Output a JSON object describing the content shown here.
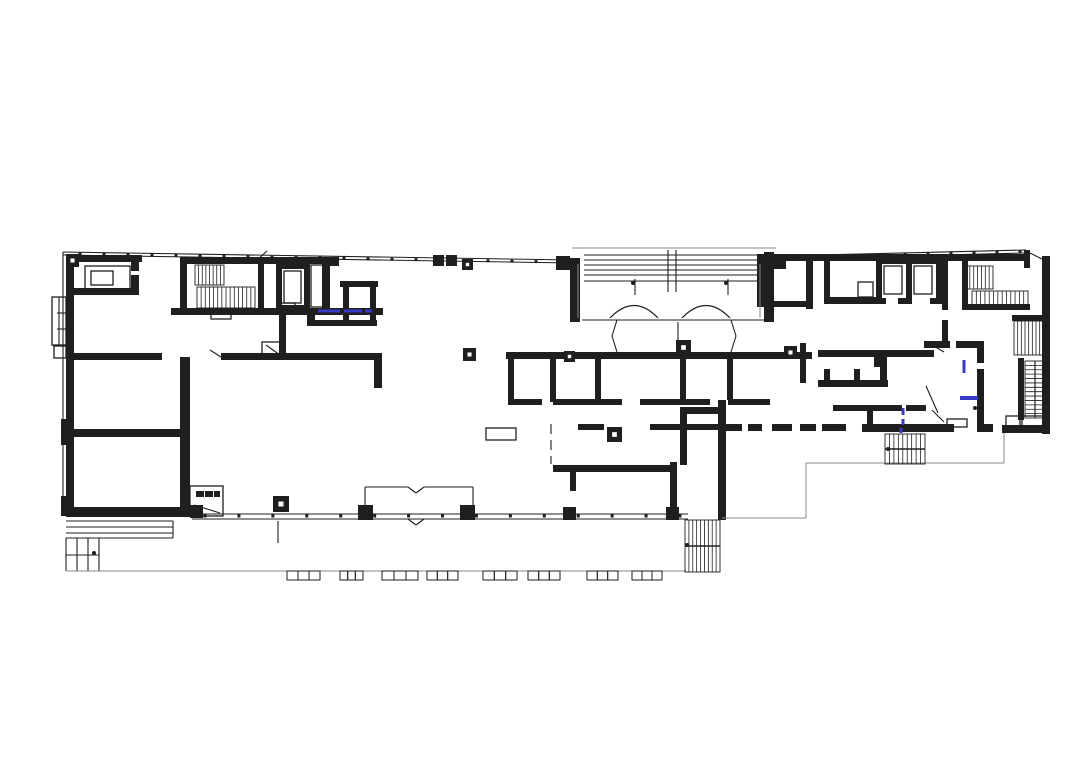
{
  "document": {
    "type": "architectural-floor-plan",
    "background": "#ffffff"
  },
  "colors": {
    "ink": "#1f1f1f",
    "faint": "#8a8a8a",
    "accent": "#3a3ac8",
    "white": "#ffffff"
  },
  "plan": {
    "canvas": {
      "w": 1072,
      "h": 768
    },
    "walls": [
      [
        66,
        255,
        76,
        7
      ],
      [
        66,
        255,
        8,
        258
      ],
      [
        66,
        288,
        70,
        7
      ],
      [
        131,
        255,
        8,
        16
      ],
      [
        131,
        275,
        8,
        20
      ],
      [
        66,
        353,
        96,
        7
      ],
      [
        221,
        353,
        160,
        7
      ],
      [
        374,
        353,
        8,
        35
      ],
      [
        66,
        429,
        124,
        8
      ],
      [
        180,
        357,
        10,
        156
      ],
      [
        66,
        507,
        128,
        10
      ],
      [
        61,
        419,
        8,
        26
      ],
      [
        61,
        496,
        8,
        20
      ],
      [
        180,
        257,
        147,
        7
      ],
      [
        171,
        308,
        212,
        7
      ],
      [
        180,
        257,
        7,
        55
      ],
      [
        258,
        263,
        6,
        45
      ],
      [
        276,
        263,
        34,
        6
      ],
      [
        276,
        305,
        34,
        6
      ],
      [
        276,
        263,
        6,
        48
      ],
      [
        304,
        263,
        6,
        48
      ],
      [
        322,
        257,
        8,
        56
      ],
      [
        279,
        311,
        7,
        46
      ],
      [
        340,
        281,
        38,
        6
      ],
      [
        343,
        283,
        6,
        40
      ],
      [
        370,
        283,
        6,
        40
      ],
      [
        307,
        312,
        8,
        14
      ],
      [
        307,
        320,
        70,
        6
      ],
      [
        757,
        254,
        272,
        7
      ],
      [
        757,
        254,
        7,
        52
      ],
      [
        806,
        261,
        7,
        48
      ],
      [
        757,
        301,
        55,
        6
      ],
      [
        824,
        261,
        6,
        42
      ],
      [
        824,
        297,
        58,
        7
      ],
      [
        876,
        258,
        6,
        46
      ],
      [
        906,
        258,
        6,
        46
      ],
      [
        936,
        258,
        6,
        46
      ],
      [
        876,
        258,
        66,
        6
      ],
      [
        876,
        298,
        10,
        6
      ],
      [
        898,
        298,
        12,
        6
      ],
      [
        930,
        298,
        12,
        6
      ],
      [
        942,
        258,
        6,
        52
      ],
      [
        942,
        320,
        6,
        28
      ],
      [
        924,
        341,
        26,
        7
      ],
      [
        956,
        341,
        26,
        7
      ],
      [
        977,
        341,
        7,
        22
      ],
      [
        977,
        369,
        7,
        62
      ],
      [
        962,
        258,
        6,
        50
      ],
      [
        962,
        304,
        68,
        6
      ],
      [
        1042,
        256,
        8,
        178
      ],
      [
        1024,
        250,
        6,
        18
      ],
      [
        1012,
        315,
        38,
        6
      ],
      [
        1018,
        358,
        6,
        62
      ],
      [
        1002,
        425,
        46,
        8
      ],
      [
        862,
        424,
        92,
        8
      ],
      [
        977,
        424,
        16,
        8
      ],
      [
        822,
        424,
        24,
        7
      ],
      [
        800,
        424,
        16,
        7
      ],
      [
        772,
        424,
        20,
        7
      ],
      [
        748,
        424,
        14,
        7
      ],
      [
        726,
        424,
        16,
        7
      ],
      [
        718,
        400,
        8,
        120
      ],
      [
        683,
        407,
        39,
        7
      ],
      [
        680,
        407,
        7,
        58
      ],
      [
        670,
        462,
        7,
        57
      ],
      [
        506,
        352,
        306,
        7
      ],
      [
        800,
        343,
        6,
        40
      ],
      [
        818,
        350,
        116,
        7
      ],
      [
        874,
        353,
        6,
        14
      ],
      [
        880,
        353,
        7,
        32
      ],
      [
        818,
        380,
        70,
        7
      ],
      [
        824,
        369,
        6,
        11
      ],
      [
        854,
        369,
        6,
        11
      ],
      [
        833,
        405,
        34,
        6
      ],
      [
        872,
        405,
        30,
        6
      ],
      [
        906,
        405,
        20,
        6
      ],
      [
        867,
        405,
        6,
        25
      ],
      [
        508,
        352,
        6,
        50
      ],
      [
        550,
        352,
        6,
        50
      ],
      [
        595,
        352,
        6,
        50
      ],
      [
        680,
        352,
        6,
        50
      ],
      [
        727,
        352,
        6,
        48
      ],
      [
        508,
        399,
        34,
        6
      ],
      [
        553,
        399,
        69,
        6
      ],
      [
        640,
        399,
        70,
        6
      ],
      [
        728,
        399,
        42,
        6
      ],
      [
        578,
        424,
        26,
        6
      ],
      [
        650,
        424,
        72,
        6
      ],
      [
        553,
        465,
        122,
        7
      ],
      [
        570,
        465,
        6,
        26
      ],
      [
        570,
        258,
        10,
        64
      ],
      [
        764,
        252,
        10,
        70
      ],
      [
        196,
        491,
        8,
        6
      ],
      [
        205,
        491,
        8,
        6
      ],
      [
        214,
        491,
        6,
        6
      ]
    ],
    "boxes": [
      [
        85,
        266,
        45,
        25
      ],
      [
        91,
        271,
        22,
        14
      ],
      [
        284,
        271,
        17,
        32
      ],
      [
        311,
        265,
        14,
        42
      ],
      [
        884,
        266,
        18,
        28
      ],
      [
        914,
        266,
        18,
        28
      ],
      [
        858,
        282,
        15,
        15
      ],
      [
        190,
        486,
        33,
        30
      ],
      [
        486,
        428,
        30,
        12
      ],
      [
        947,
        419,
        20,
        8
      ],
      [
        1006,
        416,
        14,
        11
      ],
      [
        1022,
        416,
        22,
        11
      ],
      [
        52,
        297,
        14,
        48
      ],
      [
        54,
        346,
        12,
        12
      ],
      [
        211,
        313,
        20,
        6
      ],
      [
        279,
        303,
        16,
        7
      ],
      [
        262,
        342,
        22,
        15
      ]
    ],
    "thin": [
      [
        63,
        252,
        572,
        260
      ],
      [
        63,
        255,
        572,
        263
      ],
      [
        776,
        256,
        1026,
        250
      ],
      [
        776,
        259,
        1026,
        253
      ],
      [
        63,
        252,
        63,
        513
      ],
      [
        584,
        255,
        764,
        255
      ],
      [
        584,
        260,
        764,
        260
      ],
      [
        584,
        265,
        764,
        265
      ],
      [
        584,
        270,
        764,
        270
      ],
      [
        584,
        275,
        764,
        275
      ],
      [
        584,
        281,
        764,
        281
      ],
      [
        582,
        320,
        764,
        320
      ],
      [
        668,
        250,
        668,
        292
      ],
      [
        676,
        250,
        676,
        292
      ],
      [
        635,
        279,
        635,
        295
      ],
      [
        728,
        279,
        728,
        295
      ],
      [
        678,
        322,
        678,
        352
      ],
      [
        192,
        514,
        688,
        514
      ],
      [
        192,
        519,
        688,
        519
      ],
      [
        365,
        487,
        408,
        487
      ],
      [
        408,
        487,
        416,
        493
      ],
      [
        416,
        493,
        424,
        487
      ],
      [
        424,
        487,
        473,
        487
      ],
      [
        365,
        487,
        365,
        514
      ],
      [
        473,
        487,
        473,
        514
      ],
      [
        408,
        519,
        416,
        525
      ],
      [
        416,
        525,
        424,
        519
      ],
      [
        66,
        521,
        173,
        521
      ],
      [
        66,
        527,
        173,
        527
      ],
      [
        66,
        533,
        173,
        533
      ],
      [
        66,
        538,
        173,
        538
      ],
      [
        173,
        521,
        173,
        538
      ],
      [
        66,
        538,
        66,
        571
      ],
      [
        77,
        538,
        77,
        571
      ],
      [
        88,
        538,
        88,
        571
      ],
      [
        99,
        538,
        99,
        571
      ],
      [
        66,
        555,
        99,
        555
      ],
      [
        66,
        571,
        99,
        571
      ],
      [
        551,
        424,
        551,
        434
      ],
      [
        551,
        440,
        551,
        450
      ],
      [
        551,
        456,
        551,
        464
      ],
      [
        278,
        521,
        278,
        543
      ],
      [
        1026,
        251,
        1046,
        261
      ],
      [
        255,
        262,
        267,
        251
      ],
      [
        926,
        386,
        938,
        413
      ],
      [
        932,
        345,
        944,
        352
      ],
      [
        210,
        350,
        221,
        357
      ],
      [
        617,
        320,
        612,
        336
      ],
      [
        612,
        336,
        617,
        352
      ],
      [
        731,
        320,
        736,
        336
      ],
      [
        736,
        336,
        731,
        352
      ],
      [
        932,
        410,
        944,
        422
      ],
      [
        266,
        345,
        280,
        355
      ],
      [
        194,
        505,
        220,
        513
      ],
      [
        57,
        313,
        66,
        313
      ],
      [
        57,
        329,
        66,
        329
      ],
      [
        59,
        297,
        59,
        345
      ]
    ],
    "faint": [
      [
        66,
        571,
        686,
        571
      ],
      [
        722,
        518,
        806,
        518
      ],
      [
        806,
        518,
        806,
        463
      ],
      [
        806,
        463,
        1004,
        463
      ],
      [
        1004,
        463,
        1004,
        433
      ],
      [
        578,
        264,
        578,
        318
      ],
      [
        760,
        264,
        760,
        318
      ],
      [
        572,
        248,
        776,
        248
      ]
    ],
    "stairs": [
      {
        "x": 195,
        "y": 265,
        "w": 29,
        "h": 20,
        "dir": "v",
        "n": 7,
        "mid": false,
        "rail": false
      },
      {
        "x": 197,
        "y": 287,
        "w": 58,
        "h": 21,
        "dir": "v",
        "n": 13,
        "mid": false,
        "rail": false
      },
      {
        "x": 966,
        "y": 266,
        "w": 27,
        "h": 23,
        "dir": "v",
        "n": 6,
        "mid": false,
        "rail": false
      },
      {
        "x": 972,
        "y": 291,
        "w": 56,
        "h": 14,
        "dir": "v",
        "n": 12,
        "mid": false,
        "rail": false
      },
      {
        "x": 1014,
        "y": 321,
        "w": 33,
        "h": 34,
        "dir": "v",
        "n": 8,
        "mid": false,
        "rail": false
      },
      {
        "x": 1025,
        "y": 361,
        "w": 20,
        "h": 57,
        "dir": "h",
        "n": 12,
        "mid": false,
        "rail": true
      },
      {
        "x": 885,
        "y": 434,
        "w": 40,
        "h": 30,
        "dir": "v",
        "n": 8,
        "mid": true,
        "rail": false
      },
      {
        "x": 685,
        "y": 520,
        "w": 35,
        "h": 52,
        "dir": "v",
        "n": 8,
        "mid": true,
        "rail": false
      }
    ],
    "columns_solid": [
      [
        556,
        256,
        14
      ],
      [
        773,
        256,
        13
      ],
      [
        433,
        255,
        11
      ],
      [
        446,
        255,
        11
      ],
      [
        330,
        257,
        9
      ],
      [
        190,
        505,
        13
      ],
      [
        358,
        505,
        15
      ],
      [
        460,
        505,
        15
      ],
      [
        563,
        507,
        13
      ],
      [
        666,
        507,
        13
      ]
    ],
    "columns_framed": [
      [
        66,
        254,
        13
      ],
      [
        462,
        259,
        11
      ],
      [
        463,
        348,
        13
      ],
      [
        564,
        351,
        11
      ],
      [
        676,
        340,
        15
      ],
      [
        607,
        427,
        15
      ],
      [
        784,
        346,
        13
      ],
      [
        273,
        496,
        16
      ]
    ],
    "arcs": [
      {
        "x1": 610,
        "y": 318,
        "cx": 634,
        "cy": 293,
        "x2": 658
      },
      {
        "x1": 682,
        "y": 318,
        "cx": 706,
        "cy": 293,
        "x2": 730
      }
    ],
    "blue": [
      [
        318,
        311,
        340,
        311,
        3
      ],
      [
        344,
        311,
        362,
        311,
        3
      ],
      [
        365,
        311,
        372,
        311,
        3
      ],
      [
        903,
        408,
        903,
        415,
        3
      ],
      [
        903,
        419,
        903,
        425,
        3
      ],
      [
        901,
        428,
        901,
        433,
        3
      ],
      [
        960,
        398,
        978,
        398,
        4
      ],
      [
        964,
        360,
        964,
        373,
        3
      ]
    ],
    "dots": [
      [
        633,
        283
      ],
      [
        726,
        283
      ],
      [
        94,
        553
      ],
      [
        975,
        408
      ],
      [
        687,
        545
      ],
      [
        888,
        449
      ]
    ],
    "ticks": [
      {
        "x1": 80,
        "y1": 254,
        "x2": 560,
        "y2": 262,
        "n": 20
      },
      {
        "x1": 205,
        "y1": 516,
        "x2": 680,
        "y2": 516,
        "n": 14
      },
      {
        "x1": 790,
        "y1": 257,
        "x2": 1020,
        "y2": 252,
        "n": 10
      }
    ],
    "modules": {
      "y": 571,
      "h": 9,
      "groups": [
        [
          287,
          320
        ],
        [
          340,
          363
        ],
        [
          382,
          418
        ],
        [
          427,
          458
        ],
        [
          483,
          517
        ],
        [
          528,
          560
        ],
        [
          587,
          618
        ],
        [
          632,
          662
        ]
      ]
    }
  }
}
